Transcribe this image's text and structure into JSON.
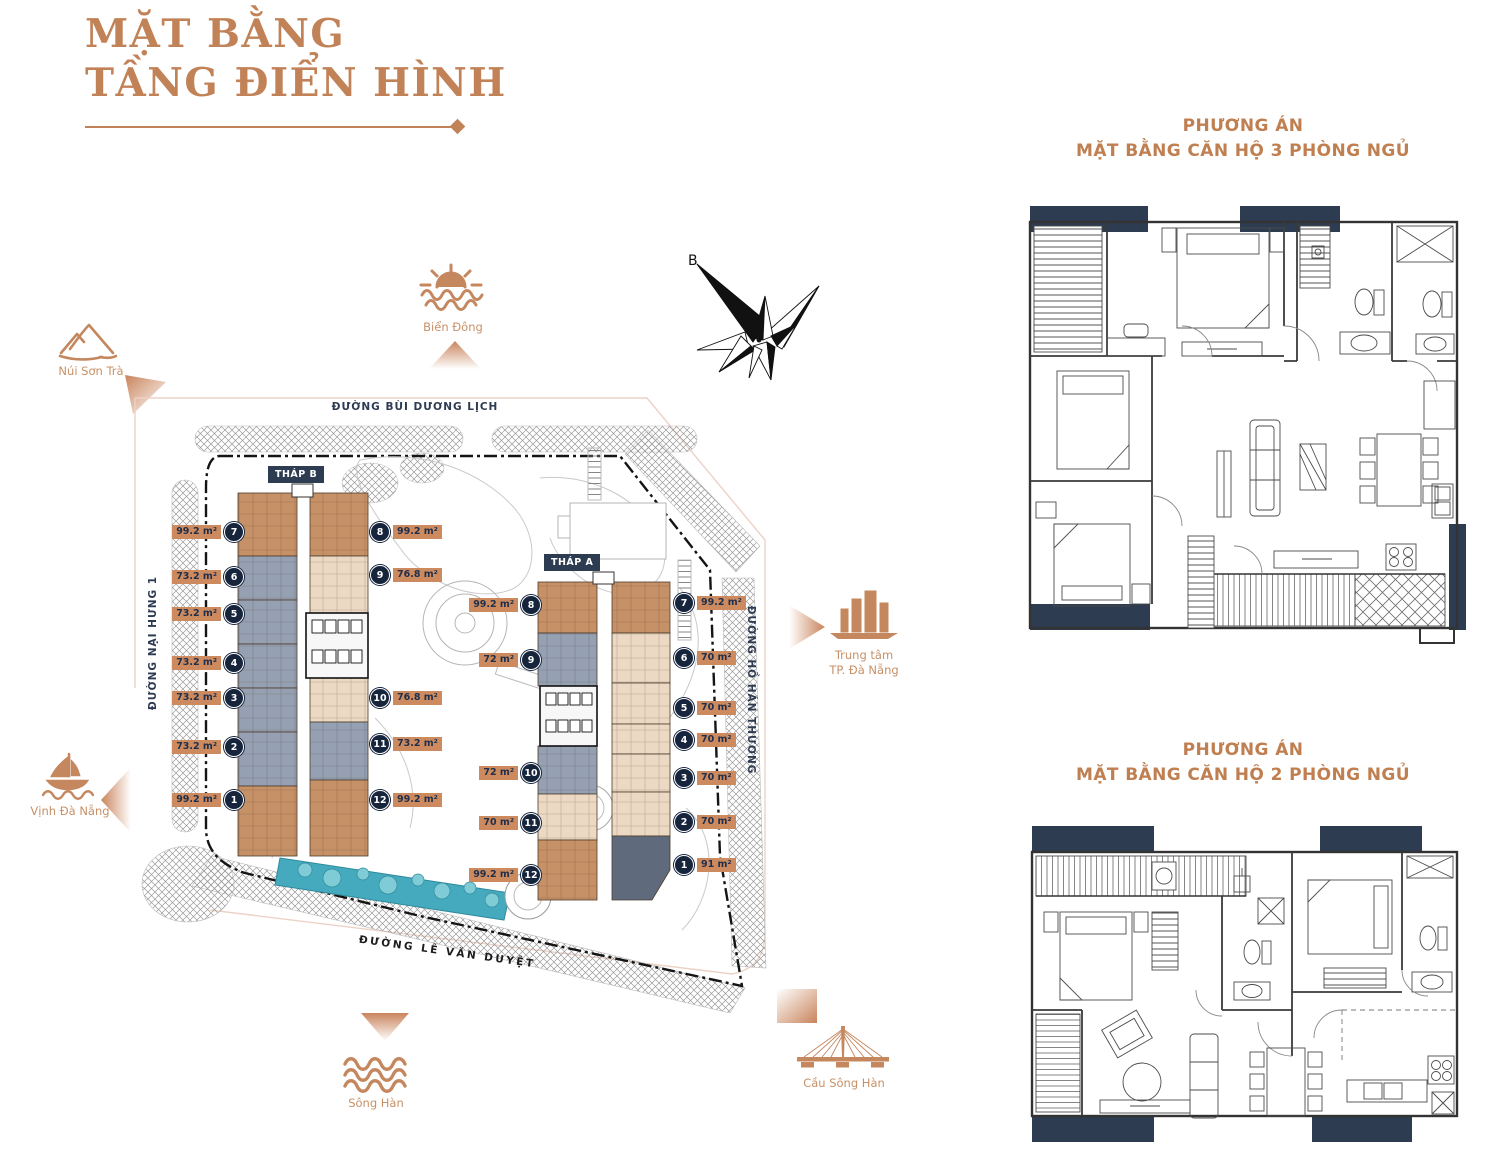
{
  "title": {
    "line1": "MẶT BẰNG",
    "line2": "TẦNG ĐIỂN HÌNH"
  },
  "colors": {
    "accent": "#c28257",
    "navy": "#2d3b52",
    "pool": "#45aabe",
    "area_badge": "#cd8a5e"
  },
  "site_plan": {
    "streets": {
      "top": "ĐƯỜNG BÙI DƯƠNG LỊCH",
      "left": "ĐƯỜNG NẠI HƯNG 1",
      "right": "ĐƯỜNG HỒ HÁN THƯƠNG",
      "bottom": "ĐƯỜNG LÊ  VĂN DUYỆT"
    },
    "tower_b_label": "THÁP B",
    "tower_a_label": "THÁP A",
    "compass": "B",
    "landmarks": {
      "nui_son_tra": "Núi Sơn Trà",
      "bien_dong": "Biển Đông",
      "vinh_da_nang": "Vịnh Đà Nẵng",
      "song_han": "Sông Hàn",
      "trung_tam_line1": "Trung tâm",
      "trung_tam_line2": "TP. Đà Nẵng",
      "cau_song_han": "Cầu Sông Hàn"
    },
    "tower_b": {
      "left": [
        {
          "no": "7",
          "area": "99.2 m²"
        },
        {
          "no": "6",
          "area": "73.2 m²"
        },
        {
          "no": "5",
          "area": "73.2 m²"
        },
        {
          "no": "4",
          "area": "73.2 m²"
        },
        {
          "no": "3",
          "area": "73.2 m²"
        },
        {
          "no": "2",
          "area": "73.2 m²"
        },
        {
          "no": "1",
          "area": "99.2 m²"
        }
      ],
      "right": [
        {
          "no": "8",
          "area": "99.2 m²"
        },
        {
          "no": "9",
          "area": "76.8 m²"
        },
        {
          "no": "10",
          "area": "76.8 m²"
        },
        {
          "no": "11",
          "area": "73.2 m²"
        },
        {
          "no": "12",
          "area": "99.2 m²"
        }
      ]
    },
    "tower_a": {
      "left": [
        {
          "no": "8",
          "area": "99.2 m²"
        },
        {
          "no": "9",
          "area": "72 m²"
        },
        {
          "no": "10",
          "area": "72 m²"
        },
        {
          "no": "11",
          "area": "70 m²"
        },
        {
          "no": "12",
          "area": "99.2 m²"
        }
      ],
      "right": [
        {
          "no": "7",
          "area": "99.2 m²"
        },
        {
          "no": "6",
          "area": "70 m²"
        },
        {
          "no": "5",
          "area": "70 m²"
        },
        {
          "no": "4",
          "area": "70 m²"
        },
        {
          "no": "3",
          "area": "70 m²"
        },
        {
          "no": "2",
          "area": "70 m²"
        },
        {
          "no": "1",
          "area": "91 m²"
        }
      ]
    }
  },
  "plan_3br": {
    "heading_line1": "PHƯƠNG ÁN",
    "heading_line2": "MẶT BẰNG CĂN HỘ 3 PHÒNG NGỦ"
  },
  "plan_2br": {
    "heading_line1": "PHƯƠNG ÁN",
    "heading_line2": "MẶT BẰNG CĂN HỘ 2 PHÒNG NGỦ"
  }
}
